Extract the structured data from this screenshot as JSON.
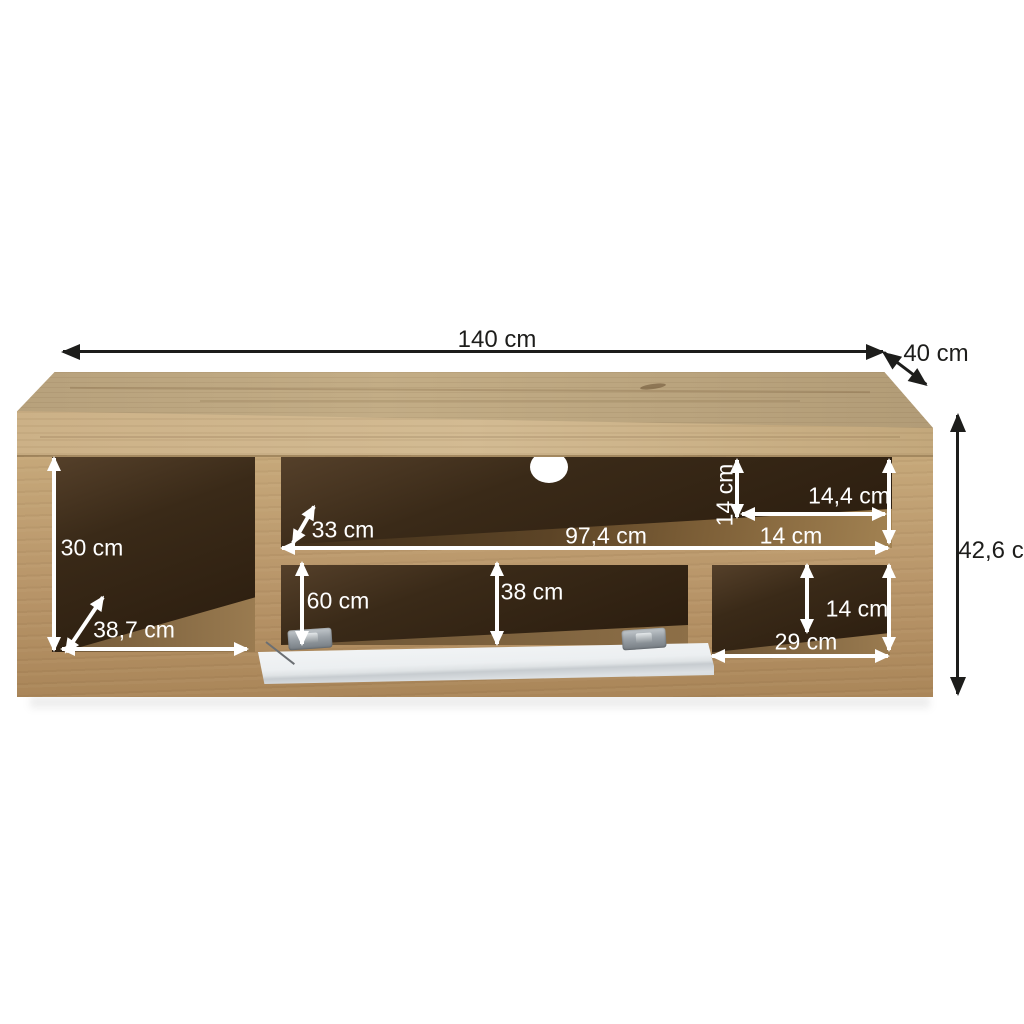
{
  "canvas": {
    "background": "#ffffff"
  },
  "colors": {
    "wood_top": "#bda77f",
    "wood_front": "#b89569",
    "interior_dark": "#32210f",
    "flap_white": "#edf0f2",
    "dimension_white": "#ffffff",
    "dimension_black": "#1d1d1b"
  },
  "dims": {
    "total_width": "140 cm",
    "total_depth": "40 cm",
    "total_height": "42,6 cm",
    "left_niche_height": "30 cm",
    "left_niche_width": "38,7 cm",
    "shelf_depth": "33 cm",
    "shelf_width": "97,4 cm",
    "right_back_height": "14 cm",
    "right_top_width": "14,4 cm",
    "right_shelf_width": "14 cm",
    "flap_niche_width": "60 cm",
    "center_niche_height": "38 cm",
    "right_bottom_height": "14 cm",
    "right_bottom_width": "29 cm"
  }
}
